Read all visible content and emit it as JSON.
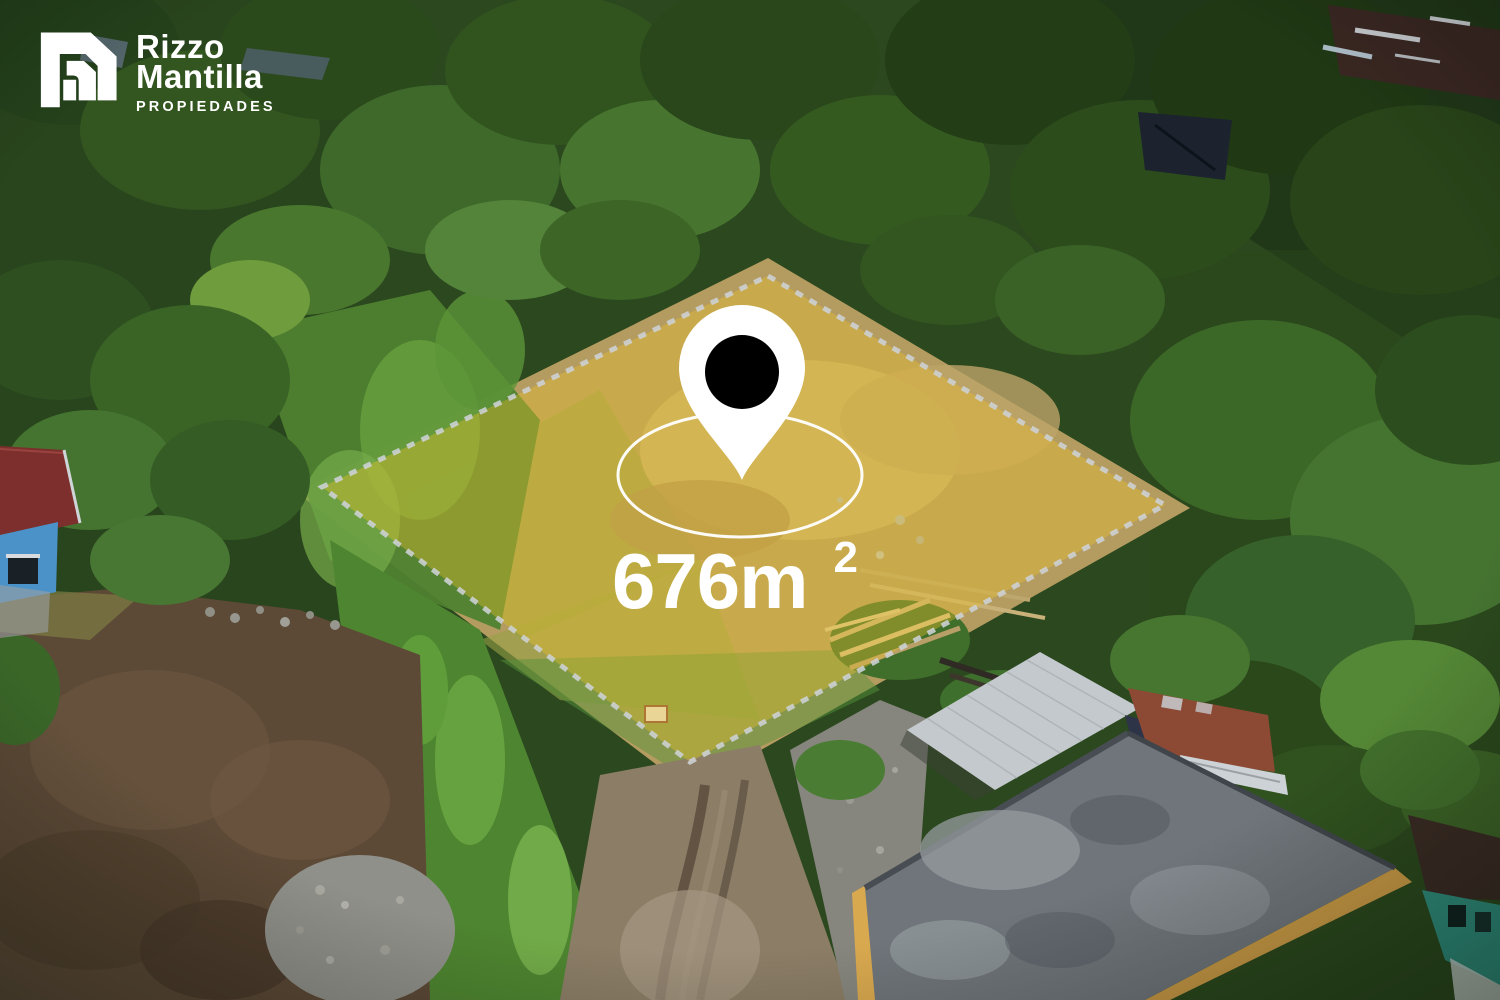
{
  "brand": {
    "line1": "Rizzo",
    "line2": "Mantilla",
    "tagline": "PROPIEDADES",
    "text_color": "#ffffff"
  },
  "parcel": {
    "area_label": "676m",
    "area_superscript": "2",
    "label_color": "#ffffff",
    "highlight_fill": "#e9c12a",
    "border_dash_color": "#cdd2d6",
    "radius_ring_color": "#ffffff",
    "pin_fill": "#ffffff",
    "pin_dot_fill": "#000000"
  }
}
